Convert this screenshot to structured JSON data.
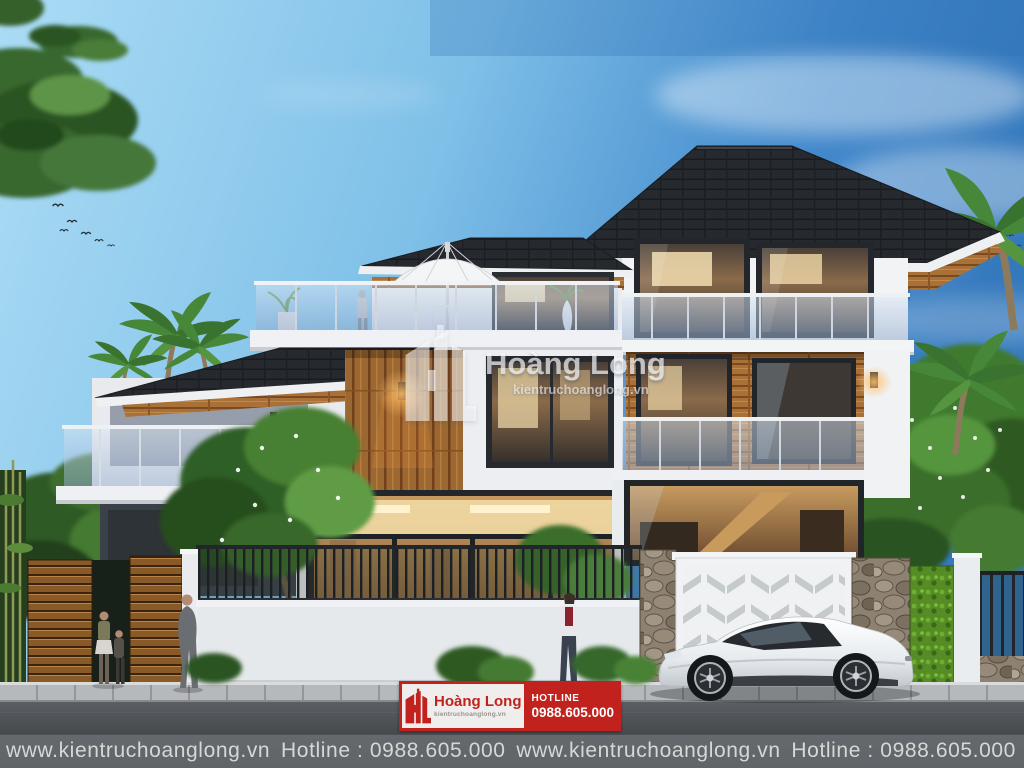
{
  "brand": {
    "name": "Hoàng Long",
    "website_short": "kientruchoanglong.vn",
    "website_full": "www.kientruchoanglong.vn",
    "hotline_label": "HOTLINE",
    "hotline_number": "0988.605.000"
  },
  "watermark": {
    "logo": "hl-logo",
    "title": "Hoàng Long",
    "website": "kientruchoanglong.vn"
  },
  "banner": {
    "logo": "hl-logo",
    "title": "Hoàng Long",
    "website": "kientruchoanglong.vn",
    "hotline_label": "HOTLINE",
    "hotline_number": "0988.605.000"
  },
  "info_bar": {
    "items": [
      {
        "website": "www.kientruchoanglong.vn",
        "hotline": "Hotline : 0988.605.000"
      },
      {
        "website": "www.kientruchoanglong.vn",
        "hotline": "Hotline : 0988.605.000"
      }
    ]
  },
  "colors": {
    "brand_red": "#c1221e",
    "banner_panel": "#efeeec",
    "watermark_white": "#ffffff",
    "sky_left": "#a9daf4",
    "sky_right": "#3b7ec2",
    "roof_charcoal": "#26292e",
    "wood_tan": "#9c6832",
    "wall_white": "#f1f3f5",
    "hedge_green": "#5d9427",
    "car_white": "#f4f6f8",
    "road_gray": "#44474b",
    "info_bar_text": "#d6d8d8"
  },
  "scene": {
    "subject": "modern three-story villa rendering",
    "time_of_day": "dusk with lit interiors",
    "vehicle": "white sports coupe"
  }
}
